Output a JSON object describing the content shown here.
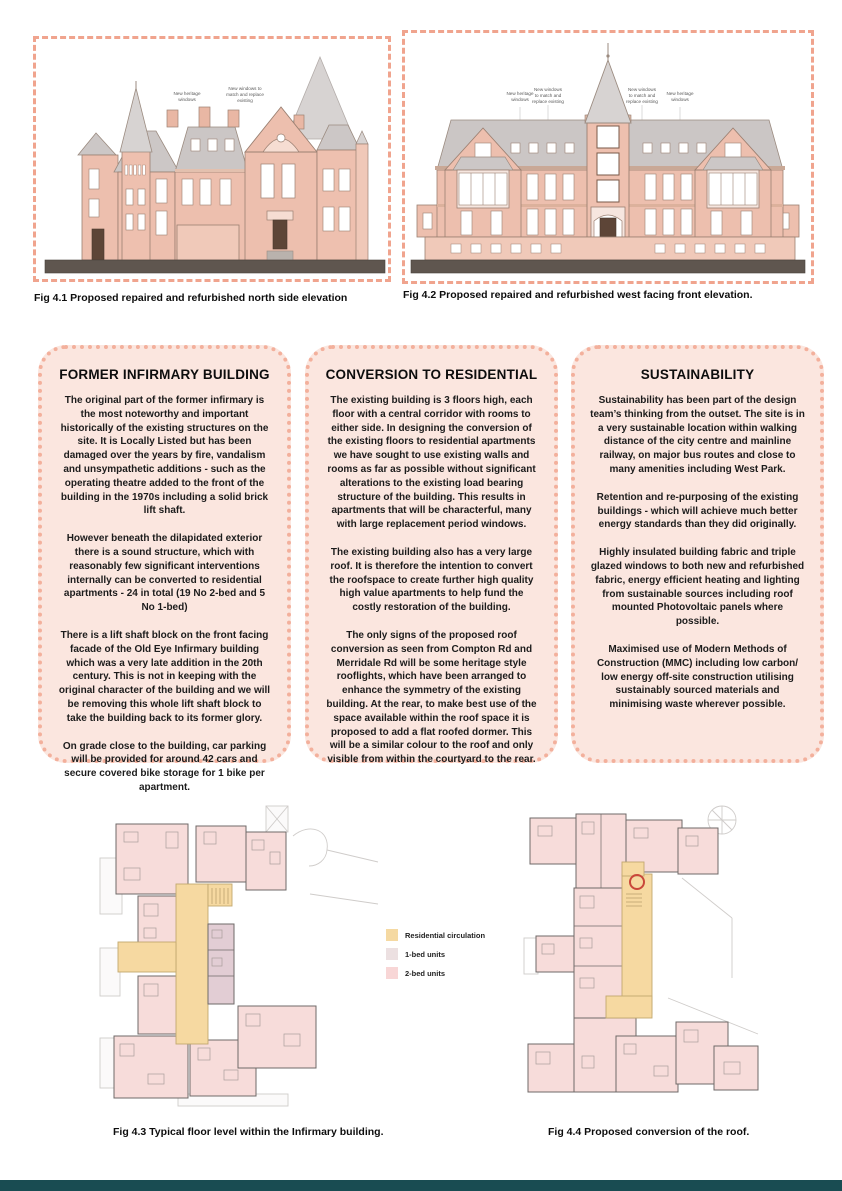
{
  "figures": {
    "fig41": {
      "caption": "Fig 4.1 Proposed repaired and refurbished north side elevation",
      "annotations": [
        "New heritage windows",
        "New windows to match and replace existing"
      ]
    },
    "fig42": {
      "caption": "Fig 4.2 Proposed repaired and refurbished west facing front elevation.",
      "annotations": [
        "New heritage windows",
        "New windows to match and replace existing",
        "New windows to match and replace existing",
        "New heritage windows"
      ]
    },
    "fig43": {
      "caption": "Fig 4.3 Typical floor level within the Infirmary building."
    },
    "fig44": {
      "caption": "Fig 4.4 Proposed conversion of the roof."
    }
  },
  "panels": [
    {
      "title": "FORMER INFIRMARY BUILDING",
      "paragraphs": [
        "The original part of the former infirmary is the most noteworthy and important historically of the existing structures on the site. It is Locally Listed but has been damaged over the years by fire, vandalism and unsympathetic additions - such as the operating theatre added to the front of the building in the 1970s including a solid brick lift shaft.",
        "However beneath the dilapidated exterior there is a sound structure, which with reasonably few significant interventions internally can be converted to residential apartments - 24 in total (19 No 2-bed and 5 No 1-bed)",
        "There is a lift shaft block on the front facing facade of the Old Eye Infirmary building which was a very late addition in the 20th century. This is not in keeping with the original character of the building and we will be removing this whole lift shaft block to take the building back to its former glory.",
        "On grade close to the building, car parking will be provided for around 42 cars and secure covered bike storage for 1 bike per apartment."
      ]
    },
    {
      "title": "CONVERSION TO RESIDENTIAL",
      "paragraphs": [
        "The existing building is 3 floors high, each floor with a central corridor with rooms to either side. In designing the conversion of the existing floors to residential apartments we have sought to use existing walls and rooms as far as possible without significant alterations to the existing load bearing structure of the building. This results in apartments that will be characterful, many with large replacement period windows.",
        "The existing building also has a very large roof. It is therefore the intention to convert the roofspace to create further high quality high value apartments to help fund the costly restoration of the building.",
        "The only signs of the proposed roof conversion as seen from Compton Rd and Merridale Rd will be some heritage style rooflights, which have been arranged to enhance the symmetry of the existing building. At the rear, to make best use of the space available within the roof space it is proposed to add a flat roofed dormer. This will be a similar colour to the roof and only visible from within the courtyard to the rear."
      ]
    },
    {
      "title": "SUSTAINABILITY",
      "paragraphs": [
        "Sustainability has been part of the design team’s thinking from the outset. The site is in a very sustainable location within walking distance of the city centre and mainline railway, on major bus routes and close to many amenities including West Park.",
        "Retention and re-purposing of the existing buildings - which will achieve much better energy standards than they did originally.",
        "Highly insulated building fabric and triple glazed windows to both new and refurbished fabric, energy efficient heating and lighting from sustainable sources including roof mounted Photovoltaic panels where possible.",
        "Maximised use of Modern Methods of Construction (MMC) including low carbon/ low energy off-site construction utilising sustainably sourced materials and minimising waste wherever possible."
      ]
    }
  ],
  "legend": {
    "items": [
      {
        "label": "Residential circulation",
        "color": "#f5d9a2"
      },
      {
        "label": "1-bed units",
        "color": "#ece0e1"
      },
      {
        "label": "2-bed units",
        "color": "#f8d6d6"
      }
    ]
  },
  "colors": {
    "dashed_border": "#f0a48e",
    "panel_background": "#fbe6df",
    "panel_border": "#f3b09c",
    "brick_wall": "#edbfae",
    "roof_grey": "#cbc6c5",
    "ground_strip": "#5f564f",
    "corridor_yellow": "#f6d9a1",
    "room_pink": "#f7dcda",
    "room_mauve": "#e2cdd4",
    "footer_bar": "#194c52"
  }
}
